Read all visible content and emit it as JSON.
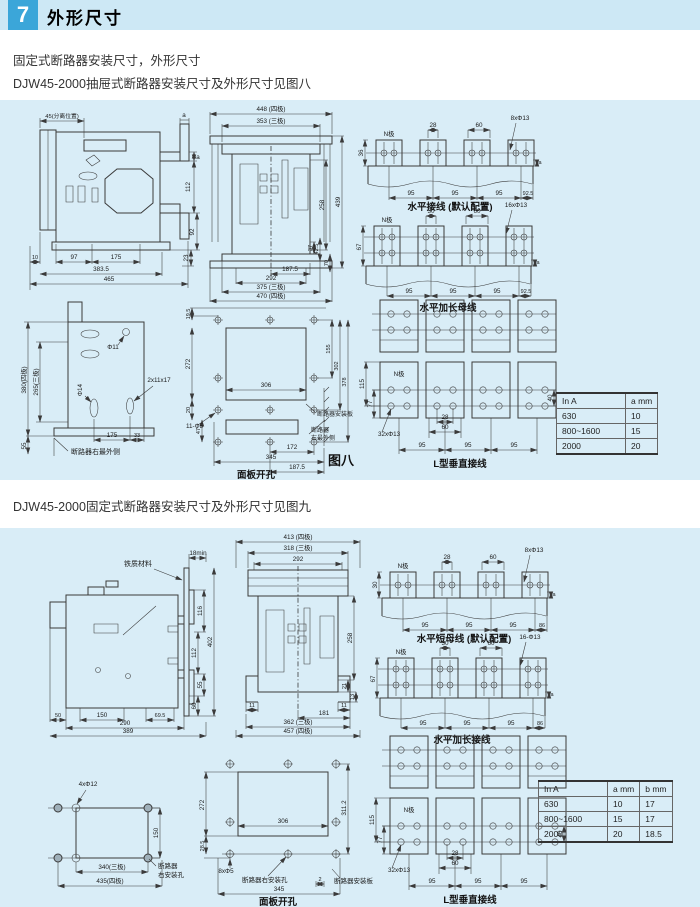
{
  "header": {
    "section_number": "7",
    "title": "外形尺寸"
  },
  "intro": {
    "line1": "固定式断路器安装尺寸，外形尺寸",
    "line2": "DJW45-2000抽屉式断路器安装尺寸及外形尺寸见图八",
    "line3": "DJW45-2000固定式断路器安装尺寸及外形尺寸见图九"
  },
  "colors": {
    "header_bg": "#cde8f5",
    "accent_blue": "#3ba6d9",
    "panel_bg": "#d9edf7",
    "line_color": "#3a3a3a"
  },
  "figure8": {
    "caption": "图八",
    "side": {
      "sep": "45(分离位置)",
      "a1": "a",
      "a2": "a",
      "d112": "112",
      "d92": "92",
      "d23": "23",
      "d10": "10",
      "d97": "97",
      "d175": "175",
      "d383": "383.5",
      "d465": "465"
    },
    "front": {
      "w4": "448 (四极)",
      "w3": "353 (三极)",
      "h439": "439",
      "h258": "258",
      "h42": "42.5",
      "h37": "37",
      "h70": "70",
      "b187": "187.5",
      "b292": "292",
      "b375": "375 (三极)",
      "b470": "470 (四极)"
    },
    "horiz1": {
      "caption": "水平接线 (默认配置)",
      "n": "N极",
      "d28": "28",
      "d60": "60",
      "holes": "8xΦ13",
      "left": "36",
      "a": "a",
      "p1": "95",
      "p2": "95",
      "p3": "95",
      "p4": "92.5"
    },
    "horiz2": {
      "caption": "水平加长母线",
      "n": "N极",
      "d30": "30",
      "d60": "60",
      "holes": "16xΦ13",
      "left": "67",
      "a": "a",
      "p1": "95",
      "p2": "95",
      "p3": "95",
      "p4": "92.5"
    },
    "lvert": {
      "caption": "L型垂直接线",
      "n": "N极",
      "h115": "115",
      "h77": "77",
      "holes": "32xΦ13",
      "d40": "40",
      "d28": "28",
      "d60": "60",
      "p1": "95",
      "p2": "95",
      "p3": "95"
    },
    "mount": {
      "h380": "380(四极)",
      "h265": "265(三极)",
      "h55": "55",
      "phi11": "Φ11",
      "phi14": "Φ14",
      "slot": "2x11x17",
      "d175": "175",
      "d33": "33",
      "note": "断路器右最外侧"
    },
    "panel": {
      "caption": "面板开孔",
      "d195": "19.5",
      "d272": "272",
      "d20": "20",
      "d47": "47",
      "d306": "306",
      "d155": "155",
      "d302": "302",
      "d378": "378",
      "holes": "11-Φ5",
      "d172": "172",
      "d345": "345",
      "d187": "187.5",
      "note_plate": "断路器安装板",
      "note_edge1": "断路器",
      "note_edge2": "右最外侧"
    },
    "table": {
      "headers": [
        "In A",
        "a mm"
      ],
      "rows": [
        [
          "630",
          "10"
        ],
        [
          "800~1600",
          "15"
        ],
        [
          "2000",
          "20"
        ]
      ]
    }
  },
  "figure9": {
    "side": {
      "d18": "18min",
      "material": "铁质材料",
      "h116": "116",
      "h402": "402",
      "h112": "112",
      "h55": "55",
      "h60": "60",
      "d50": "50",
      "d150": "150",
      "d69": "69.5",
      "d290": "290",
      "d389": "389"
    },
    "front": {
      "w4": "413 (四极)",
      "w3": "318 (三极)",
      "w292": "292",
      "h258": "258",
      "h21": "21",
      "h13": "13",
      "d11a": "11",
      "d11b": "11",
      "d181": "181",
      "b362": "362 (三极)",
      "b457": "457 (四极)"
    },
    "horiz1": {
      "caption": "水平短母线 (默认配置)",
      "n": "N极",
      "d28": "28",
      "d60": "60",
      "holes": "8xΦ13",
      "left": "30",
      "a": "a",
      "p1": "95",
      "p2": "95",
      "p3": "95",
      "p4": "86"
    },
    "horiz2": {
      "caption": "水平加长接线",
      "n": "N极",
      "d30": "30",
      "d60": "60",
      "holes": "16-Φ13",
      "left": "67",
      "a": "a",
      "p1": "95",
      "p2": "95",
      "p3": "95",
      "p4": "86"
    },
    "lvert": {
      "caption": "L型垂直接线",
      "n": "N极",
      "h115": "115",
      "h77": "77",
      "holes": "32xΦ13",
      "d40": "40",
      "d28": "28",
      "d60": "60",
      "p1": "95",
      "p2": "95",
      "p3": "95"
    },
    "mount": {
      "holes": "4xΦ12",
      "h150": "150",
      "b340": "340(三极)",
      "b435": "435(四极)",
      "note1": "断路器",
      "note2": "右安装孔"
    },
    "panel": {
      "caption": "面板开孔",
      "d272": "272",
      "d285": "28.5",
      "d306": "306",
      "d311": "311.2",
      "holes": "8xΦ5",
      "note_hole": "断路器右安装孔",
      "d2": "2",
      "note_plate": "断路器安装板",
      "d345": "345"
    },
    "table": {
      "headers": [
        "In A",
        "a mm",
        "b mm"
      ],
      "rows": [
        [
          "630",
          "10",
          "17"
        ],
        [
          "800~1600",
          "15",
          "17"
        ],
        [
          "2000",
          "20",
          "18.5"
        ]
      ]
    }
  }
}
